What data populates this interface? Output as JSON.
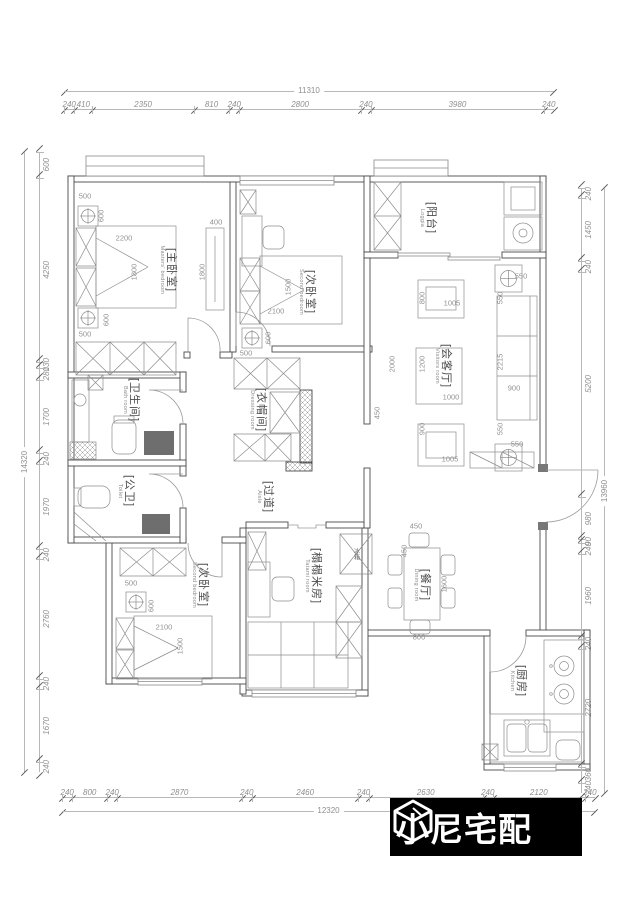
{
  "brand": {
    "name": "小尼宅配"
  },
  "dims": {
    "top": {
      "total": "11310",
      "segments": [
        "240",
        "410",
        "2350",
        "810",
        "240",
        "2800",
        "240",
        "3980",
        "240"
      ]
    },
    "bottom": {
      "total": "12320",
      "segments": [
        "240",
        "800",
        "240",
        "2870",
        "240",
        "2460",
        "240",
        "2630",
        "240",
        "2120",
        "240"
      ]
    },
    "left": {
      "total": "14320",
      "segments": [
        "600",
        "4250",
        "130",
        "280",
        "1700",
        "240",
        "1970",
        "240",
        "2760",
        "240",
        "1670",
        "240"
      ]
    },
    "right": {
      "total": "13960",
      "segments": [
        "240",
        "1450",
        "240",
        "5200",
        "980",
        "90",
        "240",
        "1960",
        "240",
        "2720",
        "360",
        "240"
      ]
    }
  },
  "rooms": {
    "master": {
      "cn": "[主卧室]",
      "en": "Masters' bedroom"
    },
    "second_top": {
      "cn": "[次卧室]",
      "en": "Second bedroom"
    },
    "loggia": {
      "cn": "[阳台]",
      "en": "Loggia"
    },
    "living": {
      "cn": "[会客厅]",
      "en": "Visitors room"
    },
    "bath": {
      "cn": "[卫生间]",
      "en": "Bath room"
    },
    "dressing": {
      "cn": "[衣帽间]",
      "en": "Dressing room"
    },
    "toilet": {
      "cn": "[公卫]",
      "en": "Toilet"
    },
    "aisle": {
      "cn": "[过道]",
      "en": "Aisle"
    },
    "second_bottom": {
      "cn": "[次卧室]",
      "en": "Second bedroom"
    },
    "tatami": {
      "cn": "[榻榻米房]",
      "en": "Tatami room"
    },
    "dining": {
      "cn": "[餐厅]",
      "en": "Dining room"
    },
    "kitchen": {
      "cn": "[厨房]",
      "en": "Kitchen"
    },
    "fridge": {
      "cn": "冰箱"
    }
  },
  "annotations": [
    {
      "t": "500",
      "x": 85,
      "y": 196
    },
    {
      "t": "600",
      "x": 101,
      "y": 216,
      "v": 1
    },
    {
      "t": "2200",
      "x": 124,
      "y": 238
    },
    {
      "t": "1800",
      "x": 134,
      "y": 272,
      "v": 1
    },
    {
      "t": "400",
      "x": 216,
      "y": 222
    },
    {
      "t": "1800",
      "x": 202,
      "y": 272,
      "v": 1
    },
    {
      "t": "600",
      "x": 106,
      "y": 320,
      "v": 1
    },
    {
      "t": "500",
      "x": 85,
      "y": 334
    },
    {
      "t": "1500",
      "x": 288,
      "y": 287,
      "v": 1
    },
    {
      "t": "2100",
      "x": 276,
      "y": 311
    },
    {
      "t": "600",
      "x": 268,
      "y": 338,
      "v": 1
    },
    {
      "t": "500",
      "x": 246,
      "y": 353
    },
    {
      "t": "550",
      "x": 521,
      "y": 276
    },
    {
      "t": "550",
      "x": 500,
      "y": 298,
      "v": 1
    },
    {
      "t": "800",
      "x": 422,
      "y": 298,
      "v": 1
    },
    {
      "t": "1005",
      "x": 452,
      "y": 303
    },
    {
      "t": "2000",
      "x": 392,
      "y": 364,
      "v": 1
    },
    {
      "t": "1200",
      "x": 422,
      "y": 364,
      "v": 1
    },
    {
      "t": "1000",
      "x": 451,
      "y": 397
    },
    {
      "t": "2215",
      "x": 500,
      "y": 362,
      "v": 1
    },
    {
      "t": "900",
      "x": 514,
      "y": 388
    },
    {
      "t": "900",
      "x": 422,
      "y": 429,
      "v": 1
    },
    {
      "t": "1005",
      "x": 450,
      "y": 459
    },
    {
      "t": "550",
      "x": 500,
      "y": 429,
      "v": 1
    },
    {
      "t": "550",
      "x": 517,
      "y": 444
    },
    {
      "t": "450",
      "x": 377,
      "y": 413,
      "v": 1
    },
    {
      "t": "500",
      "x": 131,
      "y": 583
    },
    {
      "t": "600",
      "x": 151,
      "y": 606,
      "v": 1
    },
    {
      "t": "2100",
      "x": 164,
      "y": 627
    },
    {
      "t": "1500",
      "x": 180,
      "y": 646,
      "v": 1
    },
    {
      "t": "450",
      "x": 416,
      "y": 526
    },
    {
      "t": "450",
      "x": 404,
      "y": 551,
      "v": 1
    },
    {
      "t": "1600",
      "x": 444,
      "y": 584,
      "v": 1
    },
    {
      "t": "800",
      "x": 419,
      "y": 637
    }
  ]
}
